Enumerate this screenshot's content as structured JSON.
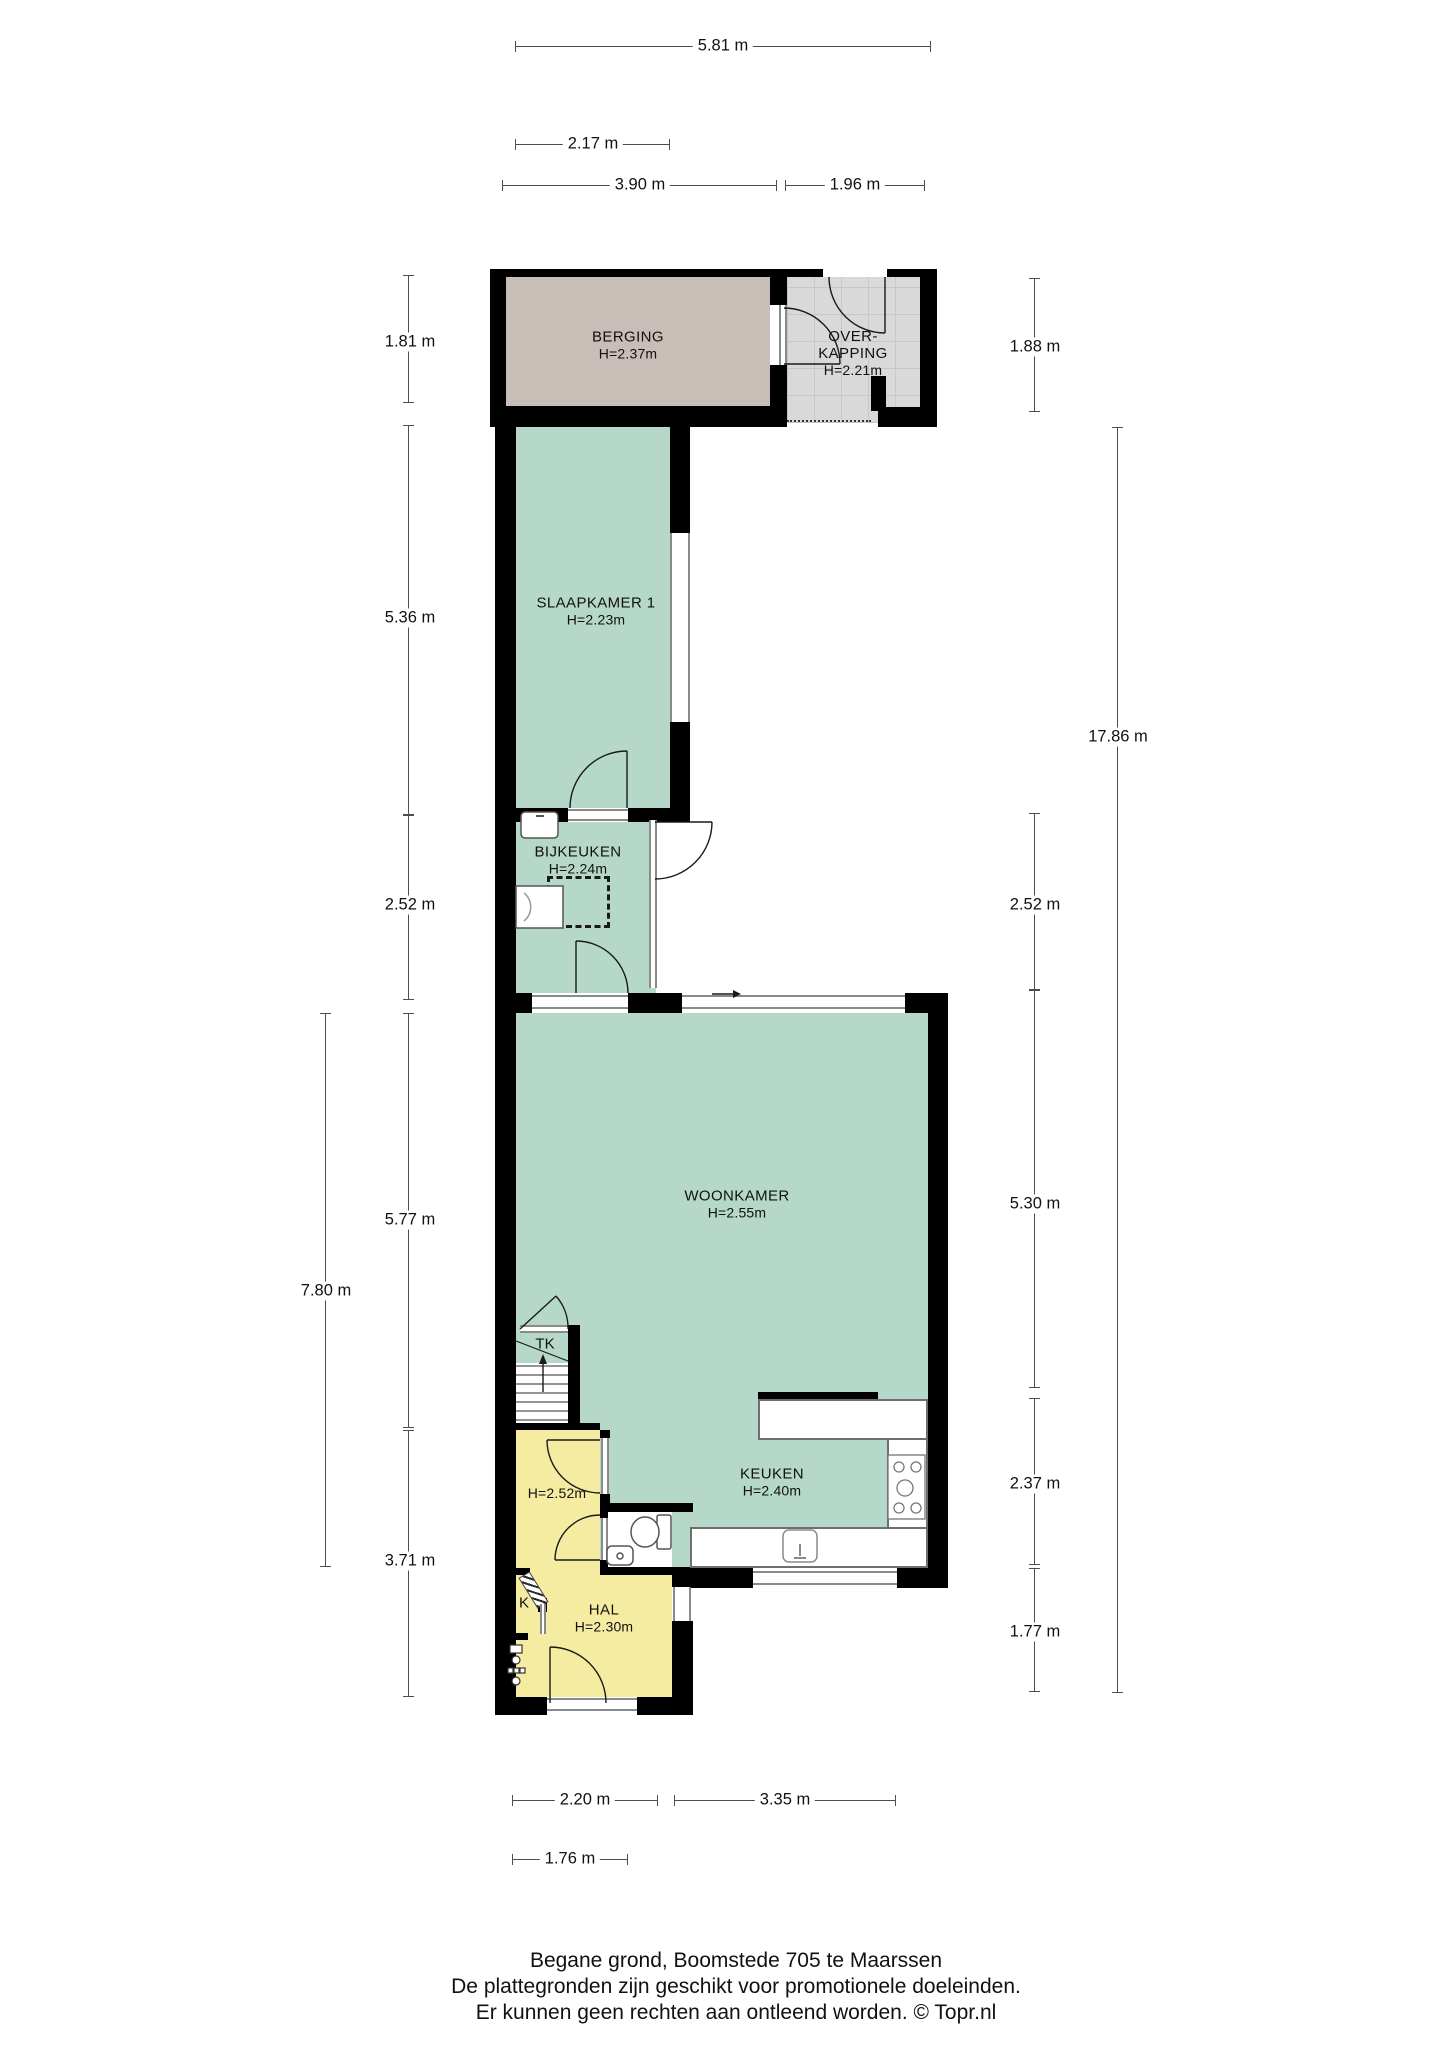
{
  "plan_title": "Begane grond, Boomstede 705 te Maarssen",
  "rooms": {
    "berging": {
      "name": "BERGING",
      "height": "H=2.37m"
    },
    "overkapping": {
      "name_line1": "OVER-",
      "name_line2": "KAPPING",
      "height": "H=2.21m"
    },
    "slaapkamer1": {
      "name": "SLAAPKAMER 1",
      "height": "H=2.23m"
    },
    "bijkeuken": {
      "name": "BIJKEUKEN",
      "height": "H=2.24m"
    },
    "woonkamer": {
      "name": "WOONKAMER",
      "height": "H=2.55m"
    },
    "keuken": {
      "name": "KEUKEN",
      "height": "H=2.40m"
    },
    "hal": {
      "name": "HAL",
      "height": "H=2.30m"
    },
    "badkamer": {
      "height": "H=2.52m"
    },
    "trapkast": {
      "name": "TK"
    },
    "kast": {
      "name": "K"
    }
  },
  "dimensions": {
    "top": [
      {
        "label": "5.81 m"
      },
      {
        "label": "2.17 m"
      },
      {
        "label": "3.90 m"
      },
      {
        "label": "1.96 m"
      }
    ],
    "left": [
      {
        "label": "1.81 m"
      },
      {
        "label": "5.36 m"
      },
      {
        "label": "2.52 m"
      },
      {
        "label": "5.77 m"
      },
      {
        "label": "7.80 m"
      },
      {
        "label": "3.71 m"
      }
    ],
    "right": [
      {
        "label": "1.88 m"
      },
      {
        "label": "2.52 m"
      },
      {
        "label": "17.86 m"
      },
      {
        "label": "5.30 m"
      },
      {
        "label": "2.37 m"
      },
      {
        "label": "1.77 m"
      }
    ],
    "bottom": [
      {
        "label": "2.20 m"
      },
      {
        "label": "3.35 m"
      },
      {
        "label": "1.76 m"
      }
    ]
  },
  "footer": {
    "line1": "Begane grond, Boomstede 705 te Maarssen",
    "line2": "De plattegronden zijn geschikt voor promotionele doeleinden.",
    "line3": "Er kunnen geen rechten aan ontleend worden. © Topr.nl"
  },
  "colors": {
    "room_green": "#b5d8c8",
    "room_yellow": "#f5eca1",
    "berging_fill": "#c8bdb7",
    "overkapping_fill": "#d9d9d9",
    "wall": "#000000",
    "dimension_line": "#4d4d4d",
    "window_frame": "#8a8a8a"
  }
}
